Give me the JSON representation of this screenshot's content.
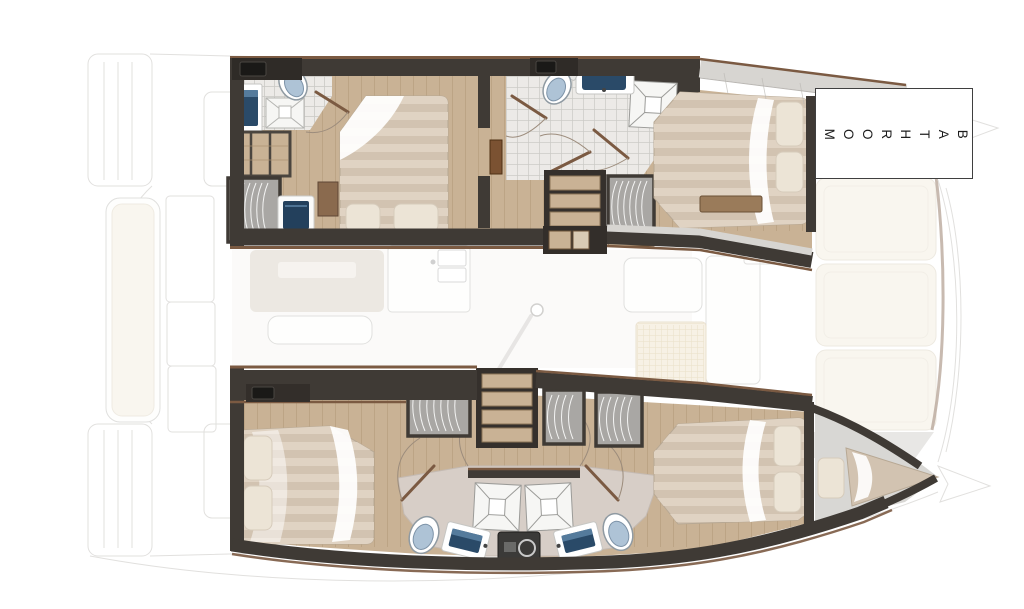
{
  "annotation": {
    "bathroom_label": "BATHROOM"
  },
  "fixture_icons": {
    "toilet": "oval-with-lid",
    "sink": "navy-basin-rect",
    "shower": "x-square-tray",
    "wardrobe": "hanger-arcs",
    "stairs": "tread-strips",
    "washer": "drum-circle",
    "door": "swing-arc-with-leaf",
    "mast": "white-circle",
    "bed": "striped-duvet-with-pillows"
  },
  "colors": {
    "wall": "#3f3a35",
    "trim": "#7b5a42",
    "wood": "#c9b295",
    "woodline": "#a98f6f",
    "tile": "#eceae7",
    "tileline": "#cbc9c5",
    "taupe": "#d7cec7",
    "duvet": "#d2c3b1",
    "duvet_stripe": "#e0d3c3",
    "pillow": "#ece4d6",
    "fold": "#ffffff",
    "toilet_lid": "#aec3d6",
    "sink_basin": "#2a4a68",
    "sink_basin_light": "#5d84a6",
    "wardrobe": "#a9a7a4",
    "hanger": "#f4f4f3",
    "cream_pad": "#f5efe2",
    "walkway": "#d7d5d1",
    "appliance": "#3b3a38",
    "faded": "#c9c7c3",
    "floor_saloon": "#f4f2ee",
    "label_border": "#3f3f3f",
    "label_text": "#1c1c1c"
  }
}
